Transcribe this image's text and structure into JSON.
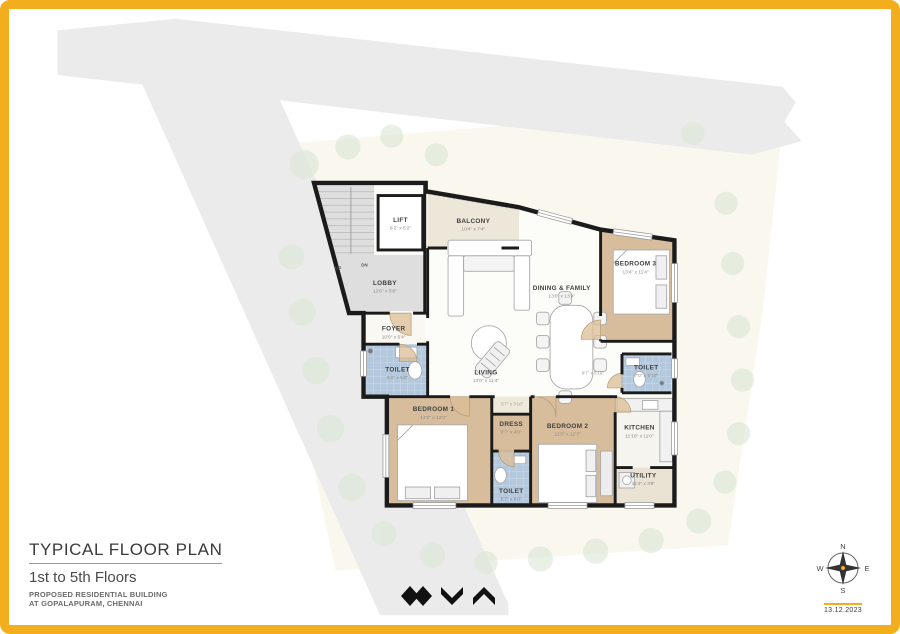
{
  "sheet": {
    "frame_color": "#F2AE1C",
    "background": "#FFFFFF"
  },
  "title_block": {
    "title": "TYPICAL FLOOR PLAN",
    "subtitle": "1st to 5th Floors",
    "line1": "PROPOSED RESIDENTIAL BUILDING",
    "line2": "AT GOPALAPURAM, CHENNAI"
  },
  "compass": {
    "north": "N",
    "east": "E",
    "south": "S",
    "west": "W",
    "date": "13.12.2023"
  },
  "rooms": {
    "lift": {
      "name": "LIFT",
      "dims": "6'2\" x 5'2\""
    },
    "balcony": {
      "name": "BALCONY",
      "dims": "10'4\" x 7'4\""
    },
    "lobby": {
      "name": "LOBBY",
      "dims": "12'6\" x 5'6\""
    },
    "foyer": {
      "name": "FOYER",
      "dims": "10'0\" x 5'4\""
    },
    "toilet_left": {
      "name": "TOILET",
      "dims": "9'2\" x 5'0\""
    },
    "living": {
      "name": "LIVING",
      "dims": "13'0\" x 11'4\""
    },
    "dining": {
      "name": "DINING & FAMILY",
      "dims": "13'0\" x 13'4\""
    },
    "bedroom3": {
      "name": "BEDROOM 3",
      "dims": "13'4\" x 11'4\""
    },
    "toilet_right": {
      "name": "TOILET",
      "dims": "7'0\" x 5'10\""
    },
    "bedroom1": {
      "name": "BEDROOM 1",
      "dims": "14'2\" x 12'0\""
    },
    "dress": {
      "name": "DRESS",
      "dims": "5'7\" x 4'0\""
    },
    "toilet_bottom": {
      "name": "TOILET",
      "dims": "5'7\" x 8'0\""
    },
    "bedroom2": {
      "name": "BEDROOM 2",
      "dims": "11'0\" x 12'7\""
    },
    "kitchen": {
      "name": "KITCHEN",
      "dims": "11'10\" x 11'0\""
    },
    "utility": {
      "name": "UTILITY",
      "dims": "11'4\" x 3'8\""
    }
  },
  "stairs": {
    "up": "UP",
    "dn": "DN"
  },
  "annotations": {
    "passage_a": "5'7\" x 3'10\"",
    "passage_b": "8'7\" x 5'10\""
  },
  "colors": {
    "road": "#EBEBEB",
    "site": "#FAF8EE",
    "wall": "#1B1B1B",
    "bedroom_floor": "#D8BD9D",
    "toilet_tile": "#B3C8DD",
    "lobby_floor": "#DEDEDE",
    "balcony_floor": "#EDE7D9",
    "utility_floor": "#EAE2D2",
    "tree": "#DCE7D4",
    "door_fan": "#DCBE96"
  }
}
